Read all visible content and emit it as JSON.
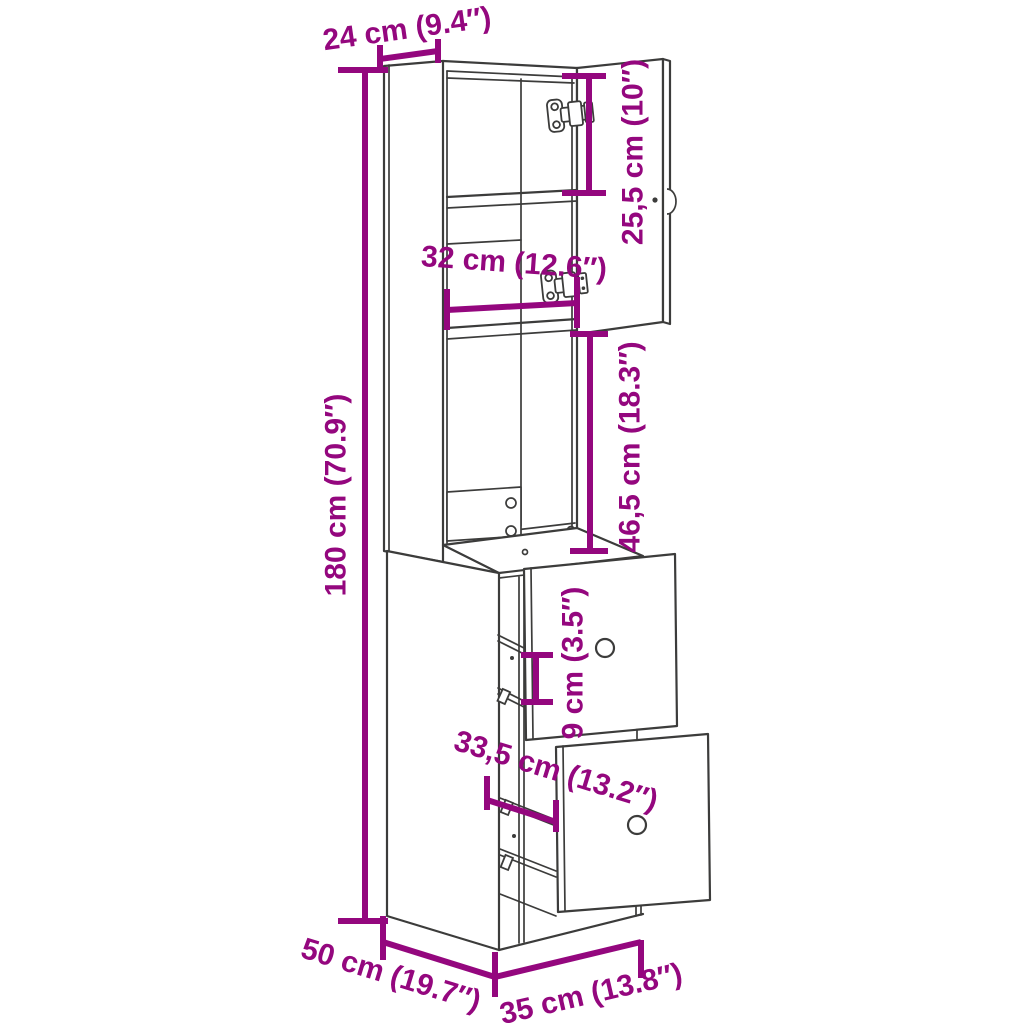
{
  "diagram": {
    "type": "furniture-dimension-diagram",
    "subject": "tall narrow cabinet with open door and two pulled-out drawers",
    "colors": {
      "dimension_accent": "#94077E",
      "outline": "#3C3C3B",
      "background": "#FFFFFF"
    },
    "labels": {
      "top_depth": "24 cm (9.4″)",
      "upper_compartment_height": "25,5 cm (10″)",
      "interior_width": "32 cm (12.6″)",
      "open_section_height": "46,5 cm (18.3″)",
      "total_height": "180 cm (70.9″)",
      "drawer_spacing": "9 cm (3.5″)",
      "drawer_depth": "33,5 cm (13.2″)",
      "base_depth": "50 cm (19.7″)",
      "base_width": "35 cm (13.8″)"
    }
  }
}
